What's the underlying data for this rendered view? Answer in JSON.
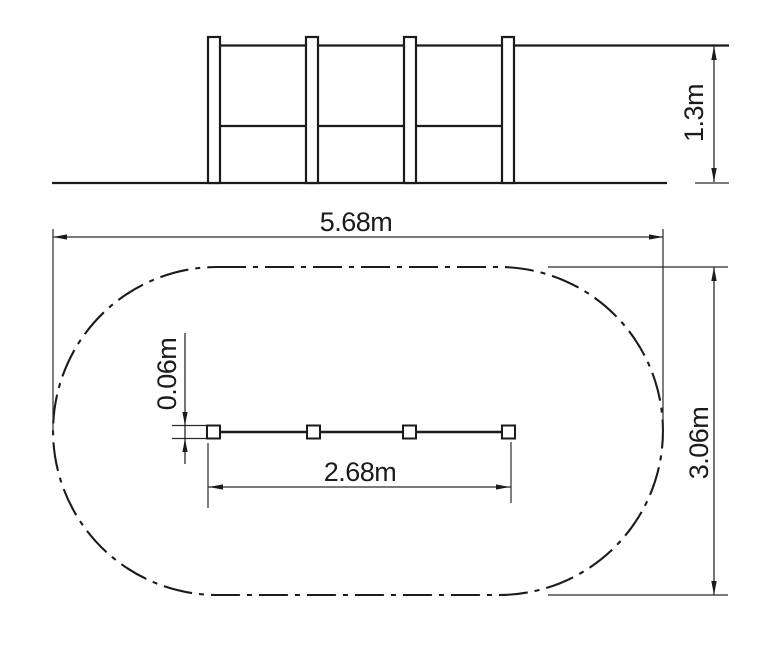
{
  "drawing": {
    "elevation_view": {
      "height_dimension": "1.3m",
      "post_count": 4
    },
    "plan_view": {
      "overall_length_dimension": "5.68m",
      "overall_width_dimension": "3.06m",
      "fence_length_dimension": "2.68m",
      "post_size_dimension": "0.06m",
      "post_marker_count": 4
    },
    "colors": {
      "line": "#1b1b1b",
      "background": "#ffffff"
    }
  }
}
